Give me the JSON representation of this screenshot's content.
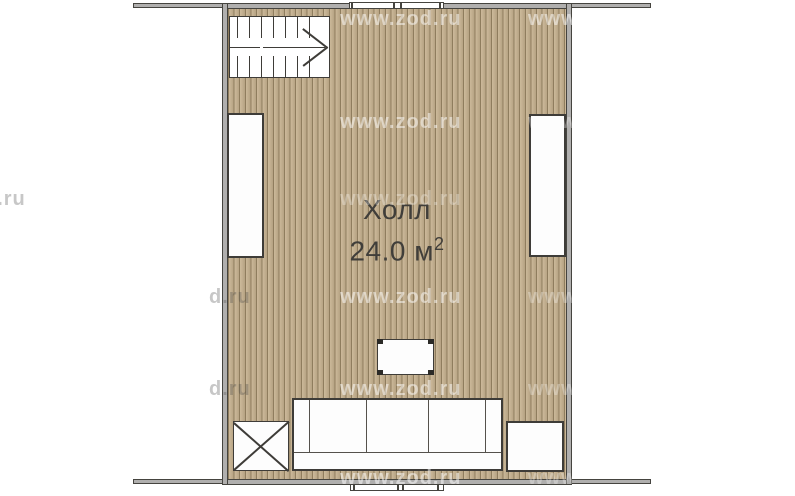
{
  "plan": {
    "room_label": "Холл",
    "area_value": "24.0",
    "area_unit": " м",
    "area_superscript": "2",
    "watermark": "www.zod.ru",
    "watermark_fragment": "d.ru",
    "colors": {
      "floor_base": "#c3b091",
      "floor_stripe": "#8f7d5e",
      "wall_fill": "#b0afae",
      "wall_outline": "#45443f",
      "furniture_fill": "#fdfdfd",
      "furniture_outline": "#3e3c38",
      "label_text": "#403e3a"
    },
    "elements": {
      "staircase": "staircase with up direction arrow",
      "top_window": "window",
      "bottom_window": "window",
      "left_rect": "built-in cabinet",
      "right_rect": "built-in cabinet",
      "center_table": "coffee table",
      "sofa": "three-seat sofa",
      "crossed_box": "crossed table",
      "bottom_right_rect": "cabinet"
    }
  }
}
